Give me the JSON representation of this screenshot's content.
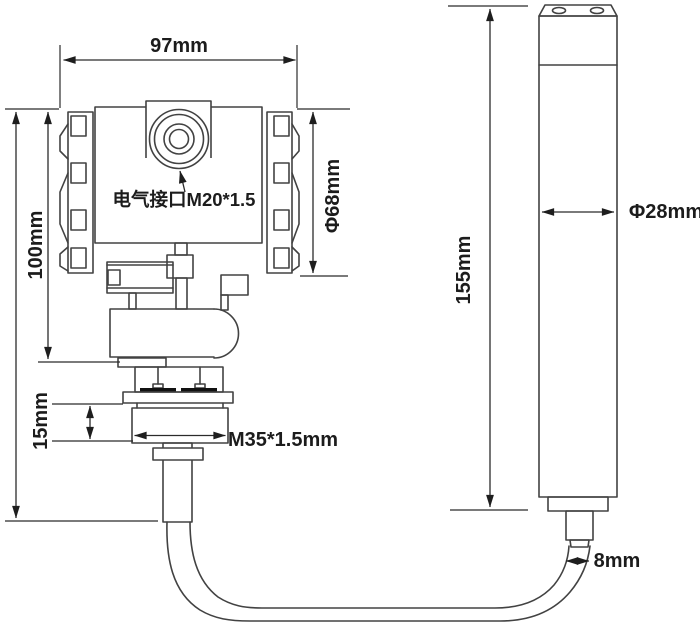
{
  "labels": {
    "housing_width": "97mm",
    "housing_height": "100mm",
    "housing_diameter": "Φ68mm",
    "electrical_port": "电气接口M20*1.5",
    "thread_length": "15mm",
    "thread_spec": "M35*1.5mm",
    "probe_length": "155mm",
    "probe_diameter": "Φ28mm",
    "cable_diameter": "8mm"
  },
  "colors": {
    "background": "#ffffff",
    "drawing_line": "#424242",
    "dimension_line": "#2b2b2b",
    "text": "#1c1c1c",
    "bolt_fill": "#111111"
  }
}
